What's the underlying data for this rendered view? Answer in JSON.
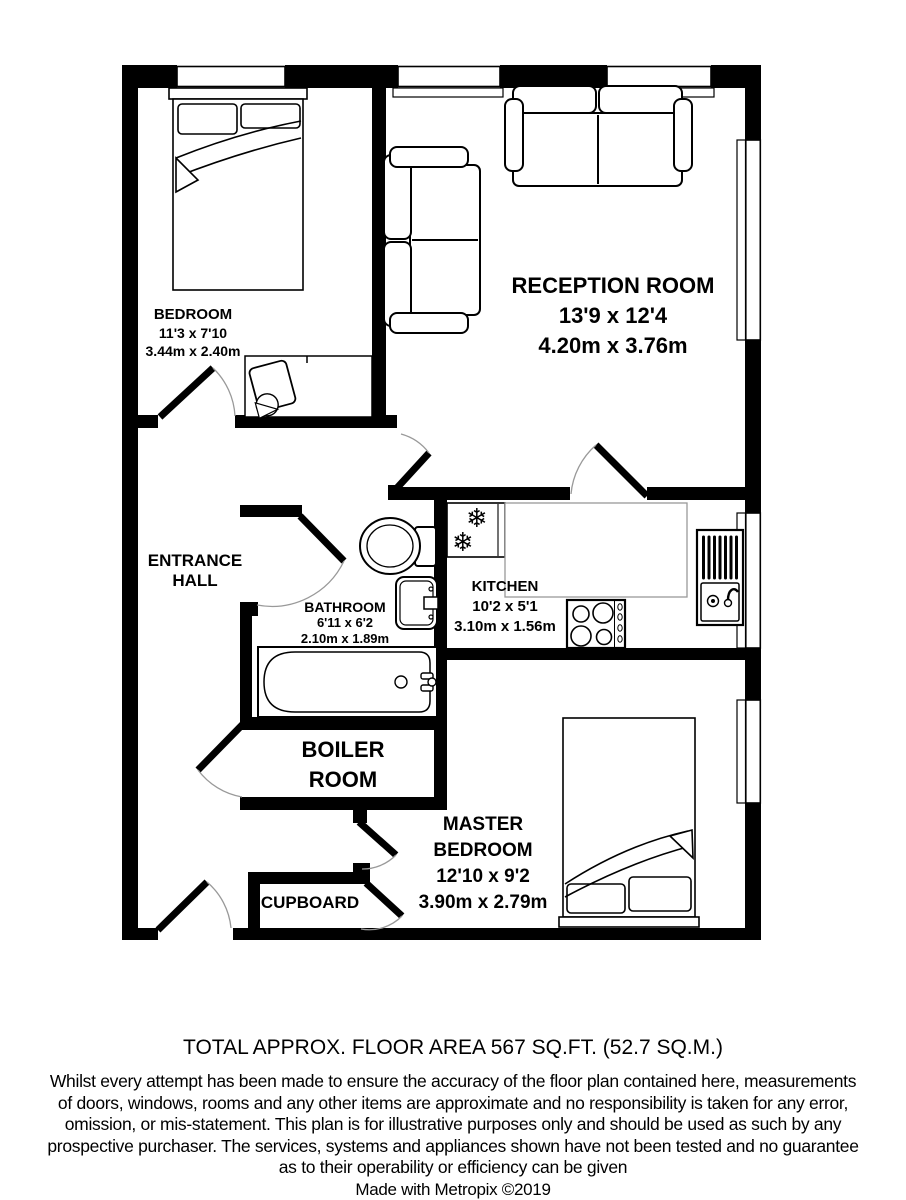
{
  "plan": {
    "rooms": {
      "bedroom": {
        "name": "BEDROOM",
        "dims_ft": "11'3 x 7'10",
        "dims_m": "3.44m x 2.40m"
      },
      "reception": {
        "name": "RECEPTION ROOM",
        "dims_ft": "13'9 x 12'4",
        "dims_m": "4.20m x 3.76m"
      },
      "entrance_hall": {
        "line1": "ENTRANCE",
        "line2": "HALL"
      },
      "bathroom": {
        "name": "BATHROOM",
        "dims_ft": "6'11 x 6'2",
        "dims_m": "2.10m x 1.89m"
      },
      "kitchen": {
        "name": "KITCHEN",
        "dims_ft": "10'2 x 5'1",
        "dims_m": "3.10m x 1.56m"
      },
      "boiler_room": {
        "line1": "BOILER",
        "line2": "ROOM"
      },
      "cupboard": {
        "name": "CUPBOARD"
      },
      "master_bedroom": {
        "line1": "MASTER",
        "line2": "BEDROOM",
        "dims_ft": "12'10 x 9'2",
        "dims_m": "3.90m x 2.79m"
      }
    },
    "icons": {
      "freezer_snowflake": "❄"
    },
    "colors": {
      "wall": "#000000",
      "worktop_outline": "#999999",
      "door_arc": "#999999"
    }
  },
  "footer": {
    "total_area": "TOTAL APPROX. FLOOR AREA 567 SQ.FT. (52.7 SQ.M.)",
    "disclaimer_lines": [
      "Whilst every attempt has been made to ensure the accuracy of the floor plan contained here, measurements",
      "of doors, windows, rooms and any other items are approximate and no responsibility is taken for any error,",
      "omission, or mis-statement. This plan is for illustrative purposes only and should be used as such by any",
      "prospective purchaser. The services, systems and appliances shown have not been tested and no guarantee",
      "as to their operability or efficiency can be given"
    ],
    "credit": "Made with Metropix ©2019"
  }
}
